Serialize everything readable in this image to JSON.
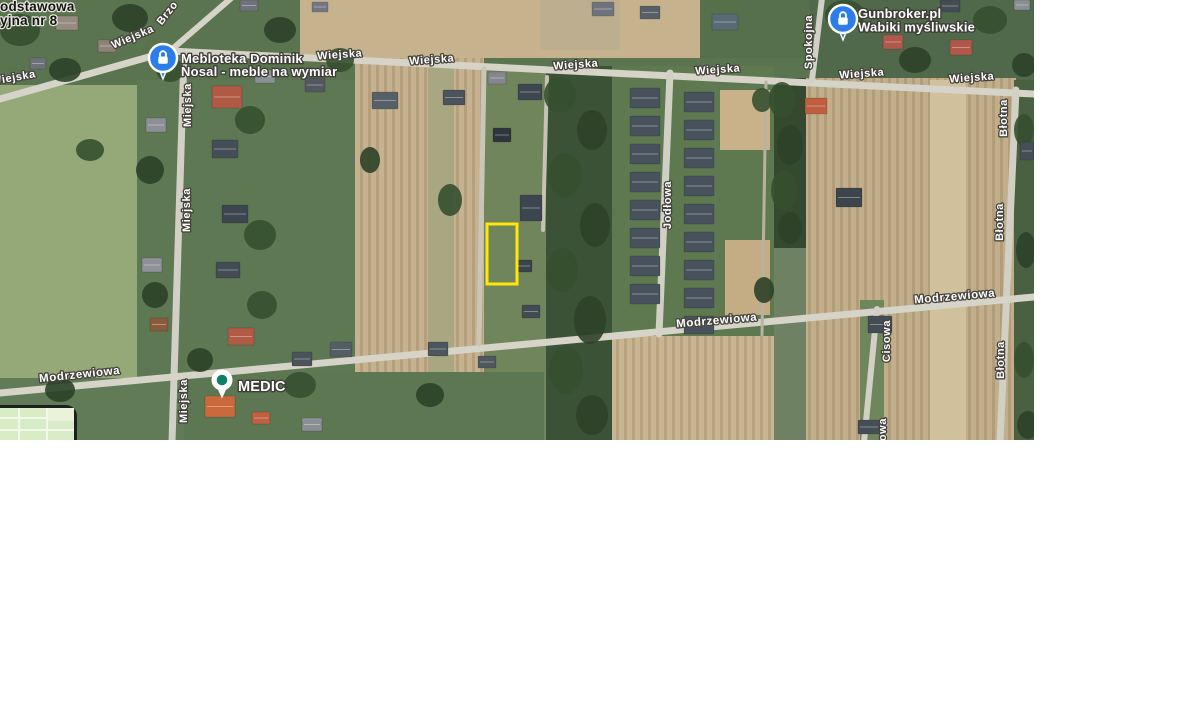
{
  "map": {
    "width": 1034,
    "height": 440,
    "base_color": "#6e8162",
    "plot_highlight": {
      "x": 487,
      "y": 224,
      "w": 30,
      "h": 60,
      "stroke": "#ffe70a",
      "stroke_width": 3
    },
    "street_labels": [
      {
        "text": "Wiejska",
        "x": 14,
        "y": 81,
        "rot": -10,
        "size": 11
      },
      {
        "text": "Wiejska",
        "x": 134,
        "y": 40,
        "rot": -23,
        "size": 11
      },
      {
        "text": "Brzo",
        "x": 170,
        "y": 15,
        "rot": -52,
        "size": 11
      },
      {
        "text": "Wiejska",
        "x": 340,
        "y": 58,
        "rot": -4,
        "size": 11
      },
      {
        "text": "Wiejska",
        "x": 432,
        "y": 63,
        "rot": -4,
        "size": 11
      },
      {
        "text": "Wiejska",
        "x": 576,
        "y": 68,
        "rot": -4,
        "size": 11
      },
      {
        "text": "Wiejska",
        "x": 718,
        "y": 73,
        "rot": -4,
        "size": 11
      },
      {
        "text": "Wiejska",
        "x": 862,
        "y": 77,
        "rot": -4,
        "size": 11
      },
      {
        "text": "Wiejska",
        "x": 972,
        "y": 81,
        "rot": -4,
        "size": 11
      },
      {
        "text": "Miejska",
        "x": 191,
        "y": 105,
        "rot": -90,
        "size": 11
      },
      {
        "text": "Miejska",
        "x": 190,
        "y": 210,
        "rot": -90,
        "size": 11
      },
      {
        "text": "Miejska",
        "x": 187,
        "y": 401,
        "rot": -90,
        "size": 11
      },
      {
        "text": "Jodłowa",
        "x": 671,
        "y": 205,
        "rot": -90,
        "size": 11
      },
      {
        "text": "Spokojna",
        "x": 812,
        "y": 42,
        "rot": -90,
        "size": 11
      },
      {
        "text": "Błotna",
        "x": 1007,
        "y": 118,
        "rot": -90,
        "size": 11
      },
      {
        "text": "Błotna",
        "x": 1003,
        "y": 222,
        "rot": -90,
        "size": 11
      },
      {
        "text": "Błotna",
        "x": 1004,
        "y": 360,
        "rot": -90,
        "size": 11
      },
      {
        "text": "Cisowa",
        "x": 890,
        "y": 341,
        "rot": -90,
        "size": 11
      },
      {
        "text": "Cisowa",
        "x": 886,
        "y": 439,
        "rot": -90,
        "size": 11
      },
      {
        "text": "Modrzewiowa",
        "x": 80,
        "y": 378,
        "rot": -6,
        "size": 11.5
      },
      {
        "text": "Modrzewiowa",
        "x": 717,
        "y": 324,
        "rot": -5,
        "size": 11.5
      },
      {
        "text": "Modrzewiowa",
        "x": 955,
        "y": 300,
        "rot": -5,
        "size": 11.5
      }
    ],
    "poi_labels": [
      {
        "lines": [
          "odstawowa",
          "yjna nr 8"
        ],
        "x": 0,
        "y": 11,
        "line_h": 14,
        "size": 13.5,
        "dark": true
      },
      {
        "lines": [
          "Mebloteka Dominik",
          "Nosal - meble na wymiar"
        ],
        "x": 181,
        "y": 63,
        "line_h": 13,
        "size": 13,
        "dark": false
      },
      {
        "lines": [
          "Gunbroker.pl",
          "Wabiki myśliwskie"
        ],
        "x": 858,
        "y": 18,
        "line_h": 13.5,
        "size": 13,
        "dark": false
      },
      {
        "lines": [
          "MEDIC"
        ],
        "x": 238,
        "y": 391,
        "line_h": 14,
        "size": 14.5,
        "dark": false
      }
    ],
    "markers": [
      {
        "type": "lock-pin",
        "name": "mebloteka-marker",
        "cx": 163,
        "cy": 58,
        "r": 14,
        "color": "#2b7de9"
      },
      {
        "type": "lock-pin",
        "name": "gunbroker-marker",
        "cx": 843,
        "cy": 19,
        "r": 14,
        "color": "#2b7de9"
      },
      {
        "type": "dot-pin",
        "name": "medic-marker",
        "cx": 222,
        "cy": 380,
        "r": 10.5,
        "color": "#ffffff",
        "dot_color": "#0b8064"
      }
    ],
    "terrain": [
      {
        "x": 0,
        "y": 0,
        "w": 1034,
        "h": 92,
        "fill": "#5a7450"
      },
      {
        "x": 300,
        "y": 0,
        "w": 512,
        "h": 58,
        "fill": "#c6b28d"
      },
      {
        "x": 540,
        "y": 0,
        "w": 80,
        "h": 50,
        "fill": "#bcae8e"
      },
      {
        "x": 700,
        "y": 0,
        "w": 112,
        "h": 58,
        "fill": "#55704b"
      },
      {
        "x": 810,
        "y": 0,
        "w": 224,
        "h": 88,
        "fill": "#50694a"
      },
      {
        "x": 0,
        "y": 85,
        "w": 137,
        "h": 355,
        "fill": "#95a878"
      },
      {
        "x": 137,
        "y": 80,
        "w": 223,
        "h": 360,
        "fill": "#5d7852"
      },
      {
        "x": 355,
        "y": 58,
        "w": 129,
        "h": 384,
        "fill": "#c6b28e",
        "pattern": true
      },
      {
        "x": 428,
        "y": 60,
        "w": 26,
        "h": 382,
        "fill": "#a8a781"
      },
      {
        "x": 484,
        "y": 66,
        "w": 62,
        "h": 376,
        "fill": "#70855c"
      },
      {
        "x": 546,
        "y": 66,
        "w": 66,
        "h": 376,
        "fill": "#3c5236"
      },
      {
        "x": 612,
        "y": 66,
        "w": 162,
        "h": 270,
        "fill": "#5e7950"
      },
      {
        "x": 720,
        "y": 90,
        "w": 50,
        "h": 60,
        "fill": "#c9b28a"
      },
      {
        "x": 725,
        "y": 240,
        "w": 45,
        "h": 75,
        "fill": "#c4ad85"
      },
      {
        "x": 612,
        "y": 336,
        "w": 162,
        "h": 106,
        "fill": "#c9b591",
        "pattern": true
      },
      {
        "x": 774,
        "y": 78,
        "w": 32,
        "h": 170,
        "fill": "#35492f"
      },
      {
        "x": 806,
        "y": 78,
        "w": 210,
        "h": 364,
        "fill": "#c2ae8a",
        "pattern": true
      },
      {
        "x": 860,
        "y": 300,
        "w": 24,
        "h": 142,
        "fill": "#6f855c"
      },
      {
        "x": 930,
        "y": 80,
        "w": 36,
        "h": 362,
        "fill": "#d0c09c"
      },
      {
        "x": 1014,
        "y": 80,
        "w": 20,
        "h": 362,
        "fill": "#4a6141"
      },
      {
        "x": 0,
        "y": 378,
        "w": 184,
        "h": 64,
        "fill": "#607b55"
      },
      {
        "x": 184,
        "y": 372,
        "w": 360,
        "h": 70,
        "fill": "#5c7751"
      }
    ],
    "roads": [
      {
        "x1": 0,
        "y1": 99,
        "x2": 170,
        "y2": 51,
        "w": 7,
        "color": "#d6d3c8"
      },
      {
        "x1": 170,
        "y1": 51,
        "x2": 1034,
        "y2": 94,
        "w": 7,
        "color": "#d6d3c8"
      },
      {
        "x1": 170,
        "y1": 51,
        "x2": 236,
        "y2": -6,
        "w": 6,
        "color": "#d6d3c8"
      },
      {
        "x1": 184,
        "y1": 54,
        "x2": 172,
        "y2": 442,
        "w": 7,
        "color": "#d2cfc4"
      },
      {
        "x1": 670,
        "y1": 73,
        "x2": 659,
        "y2": 334,
        "w": 7,
        "color": "#d2cfc4"
      },
      {
        "x1": 822,
        "y1": -2,
        "x2": 812,
        "y2": 80,
        "w": 6,
        "color": "#d2cfc4"
      },
      {
        "x1": 1016,
        "y1": 90,
        "x2": 1000,
        "y2": 442,
        "w": 7,
        "color": "#d2cfc4"
      },
      {
        "x1": 0,
        "y1": 393,
        "x2": 1034,
        "y2": 297,
        "w": 7,
        "color": "#d6d3c8"
      },
      {
        "x1": 877,
        "y1": 309,
        "x2": 864,
        "y2": 442,
        "w": 6,
        "color": "#d2cfc4"
      },
      {
        "x1": 484,
        "y1": 69,
        "x2": 479,
        "y2": 344,
        "w": 5,
        "color": "#c9c6b8"
      },
      {
        "x1": 547,
        "y1": 77,
        "x2": 543,
        "y2": 230,
        "w": 4,
        "color": "#c6c3b5"
      },
      {
        "x1": 766,
        "y1": 82,
        "x2": 762,
        "y2": 335,
        "w": 3,
        "color": "#b9b2a0"
      }
    ],
    "houses": [
      {
        "x": 630,
        "y": 88,
        "w": 30,
        "h": 20,
        "fill": "#48525c"
      },
      {
        "x": 630,
        "y": 116,
        "w": 30,
        "h": 20,
        "fill": "#48525c"
      },
      {
        "x": 630,
        "y": 144,
        "w": 30,
        "h": 20,
        "fill": "#48525c"
      },
      {
        "x": 630,
        "y": 172,
        "w": 30,
        "h": 20,
        "fill": "#48525c"
      },
      {
        "x": 630,
        "y": 200,
        "w": 30,
        "h": 20,
        "fill": "#48525c"
      },
      {
        "x": 630,
        "y": 228,
        "w": 30,
        "h": 20,
        "fill": "#48525c"
      },
      {
        "x": 630,
        "y": 256,
        "w": 30,
        "h": 20,
        "fill": "#48525c"
      },
      {
        "x": 630,
        "y": 284,
        "w": 30,
        "h": 20,
        "fill": "#48525c"
      },
      {
        "x": 684,
        "y": 92,
        "w": 30,
        "h": 20,
        "fill": "#48525c"
      },
      {
        "x": 684,
        "y": 120,
        "w": 30,
        "h": 20,
        "fill": "#48525c"
      },
      {
        "x": 684,
        "y": 148,
        "w": 30,
        "h": 20,
        "fill": "#48525c"
      },
      {
        "x": 684,
        "y": 176,
        "w": 30,
        "h": 20,
        "fill": "#48525c"
      },
      {
        "x": 684,
        "y": 204,
        "w": 30,
        "h": 20,
        "fill": "#48525c"
      },
      {
        "x": 684,
        "y": 232,
        "w": 30,
        "h": 20,
        "fill": "#48525c"
      },
      {
        "x": 684,
        "y": 260,
        "w": 30,
        "h": 20,
        "fill": "#48525c"
      },
      {
        "x": 684,
        "y": 288,
        "w": 30,
        "h": 20,
        "fill": "#48525c"
      },
      {
        "x": 684,
        "y": 316,
        "w": 30,
        "h": 18,
        "fill": "#48525c"
      },
      {
        "x": 56,
        "y": 16,
        "w": 22,
        "h": 14,
        "fill": "#968b7f"
      },
      {
        "x": 98,
        "y": 40,
        "w": 18,
        "h": 12,
        "fill": "#8e8176"
      },
      {
        "x": 30,
        "y": 58,
        "w": 16,
        "h": 11,
        "fill": "#70707a"
      },
      {
        "x": 212,
        "y": 86,
        "w": 30,
        "h": 22,
        "fill": "#b05a46"
      },
      {
        "x": 255,
        "y": 70,
        "w": 20,
        "h": 13,
        "fill": "#8d9096"
      },
      {
        "x": 305,
        "y": 78,
        "w": 20,
        "h": 14,
        "fill": "#52585f"
      },
      {
        "x": 372,
        "y": 92,
        "w": 26,
        "h": 17,
        "fill": "#575f67"
      },
      {
        "x": 443,
        "y": 90,
        "w": 22,
        "h": 15,
        "fill": "#4b535b"
      },
      {
        "x": 488,
        "y": 72,
        "w": 18,
        "h": 12,
        "fill": "#83868e"
      },
      {
        "x": 518,
        "y": 84,
        "w": 24,
        "h": 16,
        "fill": "#3e4750"
      },
      {
        "x": 493,
        "y": 128,
        "w": 18,
        "h": 14,
        "fill": "#2f373d"
      },
      {
        "x": 520,
        "y": 195,
        "w": 22,
        "h": 26,
        "fill": "#3d454f"
      },
      {
        "x": 516,
        "y": 260,
        "w": 16,
        "h": 12,
        "fill": "#3a424a"
      },
      {
        "x": 522,
        "y": 305,
        "w": 18,
        "h": 13,
        "fill": "#424a52"
      },
      {
        "x": 212,
        "y": 140,
        "w": 26,
        "h": 18,
        "fill": "#454e57"
      },
      {
        "x": 146,
        "y": 118,
        "w": 20,
        "h": 14,
        "fill": "#8c8f95"
      },
      {
        "x": 222,
        "y": 205,
        "w": 26,
        "h": 18,
        "fill": "#3d4650"
      },
      {
        "x": 142,
        "y": 258,
        "w": 20,
        "h": 14,
        "fill": "#8e9197"
      },
      {
        "x": 216,
        "y": 262,
        "w": 24,
        "h": 16,
        "fill": "#434c55"
      },
      {
        "x": 150,
        "y": 318,
        "w": 18,
        "h": 13,
        "fill": "#8b5a3e"
      },
      {
        "x": 228,
        "y": 328,
        "w": 26,
        "h": 17,
        "fill": "#b15b47"
      },
      {
        "x": 240,
        "y": 0,
        "w": 18,
        "h": 11,
        "fill": "#6f727a"
      },
      {
        "x": 312,
        "y": 2,
        "w": 16,
        "h": 10,
        "fill": "#74777f"
      },
      {
        "x": 592,
        "y": 2,
        "w": 22,
        "h": 14,
        "fill": "#70737b"
      },
      {
        "x": 640,
        "y": 6,
        "w": 20,
        "h": 13,
        "fill": "#585f67"
      },
      {
        "x": 712,
        "y": 14,
        "w": 26,
        "h": 16,
        "fill": "#5a6a74"
      },
      {
        "x": 883,
        "y": 35,
        "w": 20,
        "h": 14,
        "fill": "#b2584a"
      },
      {
        "x": 950,
        "y": 40,
        "w": 22,
        "h": 15,
        "fill": "#b2584a"
      },
      {
        "x": 940,
        "y": 0,
        "w": 20,
        "h": 12,
        "fill": "#444c54"
      },
      {
        "x": 1014,
        "y": 0,
        "w": 16,
        "h": 10,
        "fill": "#8a8d93"
      },
      {
        "x": 805,
        "y": 98,
        "w": 22,
        "h": 16,
        "fill": "#bf5e3e"
      },
      {
        "x": 836,
        "y": 188,
        "w": 26,
        "h": 19,
        "fill": "#3c444c"
      },
      {
        "x": 868,
        "y": 316,
        "w": 24,
        "h": 17,
        "fill": "#444c54"
      },
      {
        "x": 858,
        "y": 420,
        "w": 22,
        "h": 14,
        "fill": "#454d55"
      },
      {
        "x": 1020,
        "y": 142,
        "w": 14,
        "h": 18,
        "fill": "#454d55"
      },
      {
        "x": 205,
        "y": 396,
        "w": 30,
        "h": 21,
        "fill": "#ca6a3c"
      },
      {
        "x": 252,
        "y": 412,
        "w": 18,
        "h": 12,
        "fill": "#bf6040"
      },
      {
        "x": 292,
        "y": 352,
        "w": 20,
        "h": 14,
        "fill": "#4a525a"
      },
      {
        "x": 330,
        "y": 342,
        "w": 22,
        "h": 15,
        "fill": "#545c64"
      },
      {
        "x": 428,
        "y": 342,
        "w": 20,
        "h": 14,
        "fill": "#4d555d"
      },
      {
        "x": 478,
        "y": 356,
        "w": 18,
        "h": 12,
        "fill": "#4f575f"
      },
      {
        "x": 302,
        "y": 418,
        "w": 20,
        "h": 13,
        "fill": "#8b8e94"
      }
    ],
    "trees": [
      {
        "cx": 560,
        "cy": 95,
        "rx": 16,
        "ry": 18
      },
      {
        "cx": 592,
        "cy": 130,
        "rx": 15,
        "ry": 20
      },
      {
        "cx": 565,
        "cy": 175,
        "rx": 17,
        "ry": 22
      },
      {
        "cx": 595,
        "cy": 225,
        "rx": 15,
        "ry": 22
      },
      {
        "cx": 562,
        "cy": 270,
        "rx": 16,
        "ry": 22
      },
      {
        "cx": 590,
        "cy": 320,
        "rx": 16,
        "ry": 24
      },
      {
        "cx": 566,
        "cy": 370,
        "rx": 17,
        "ry": 24
      },
      {
        "cx": 592,
        "cy": 415,
        "rx": 16,
        "ry": 20
      },
      {
        "cx": 782,
        "cy": 100,
        "rx": 13,
        "ry": 18
      },
      {
        "cx": 790,
        "cy": 145,
        "rx": 13,
        "ry": 20
      },
      {
        "cx": 784,
        "cy": 190,
        "rx": 13,
        "ry": 20
      },
      {
        "cx": 790,
        "cy": 228,
        "rx": 12,
        "ry": 16
      },
      {
        "cx": 20,
        "cy": 30,
        "rx": 20,
        "ry": 16
      },
      {
        "cx": 130,
        "cy": 18,
        "rx": 18,
        "ry": 14
      },
      {
        "cx": 170,
        "cy": 70,
        "rx": 14,
        "ry": 12
      },
      {
        "cx": 280,
        "cy": 30,
        "rx": 16,
        "ry": 13
      },
      {
        "cx": 340,
        "cy": 60,
        "rx": 14,
        "ry": 12
      },
      {
        "cx": 65,
        "cy": 70,
        "rx": 16,
        "ry": 12
      },
      {
        "cx": 250,
        "cy": 120,
        "rx": 15,
        "ry": 14
      },
      {
        "cx": 150,
        "cy": 170,
        "rx": 14,
        "ry": 14
      },
      {
        "cx": 260,
        "cy": 235,
        "rx": 16,
        "ry": 15
      },
      {
        "cx": 155,
        "cy": 295,
        "rx": 13,
        "ry": 13
      },
      {
        "cx": 262,
        "cy": 305,
        "rx": 15,
        "ry": 14
      },
      {
        "cx": 200,
        "cy": 360,
        "rx": 13,
        "ry": 12
      },
      {
        "cx": 300,
        "cy": 385,
        "rx": 16,
        "ry": 13
      },
      {
        "cx": 430,
        "cy": 395,
        "rx": 14,
        "ry": 12
      },
      {
        "cx": 845,
        "cy": 15,
        "rx": 20,
        "ry": 15
      },
      {
        "cx": 915,
        "cy": 60,
        "rx": 16,
        "ry": 13
      },
      {
        "cx": 990,
        "cy": 20,
        "rx": 17,
        "ry": 14
      },
      {
        "cx": 1024,
        "cy": 65,
        "rx": 12,
        "ry": 12
      },
      {
        "cx": 1024,
        "cy": 130,
        "rx": 10,
        "ry": 16
      },
      {
        "cx": 1026,
        "cy": 250,
        "rx": 10,
        "ry": 18
      },
      {
        "cx": 1024,
        "cy": 360,
        "rx": 10,
        "ry": 18
      },
      {
        "cx": 1028,
        "cy": 425,
        "rx": 11,
        "ry": 14
      },
      {
        "cx": 90,
        "cy": 150,
        "rx": 14,
        "ry": 11
      },
      {
        "cx": 60,
        "cy": 390,
        "rx": 15,
        "ry": 12
      },
      {
        "cx": 762,
        "cy": 100,
        "rx": 10,
        "ry": 12
      },
      {
        "cx": 764,
        "cy": 290,
        "rx": 10,
        "ry": 13
      },
      {
        "cx": 450,
        "cy": 200,
        "rx": 12,
        "ry": 16
      },
      {
        "cx": 370,
        "cy": 160,
        "rx": 10,
        "ry": 13
      }
    ],
    "inset": {
      "bg": "#d9ecc8",
      "border": "#1e1e1e",
      "vlines_x": [
        18,
        46
      ],
      "hlines_y": [
        9,
        21
      ],
      "patch": {
        "x": 48,
        "y": 0,
        "w": 26,
        "h": 13
      }
    }
  }
}
